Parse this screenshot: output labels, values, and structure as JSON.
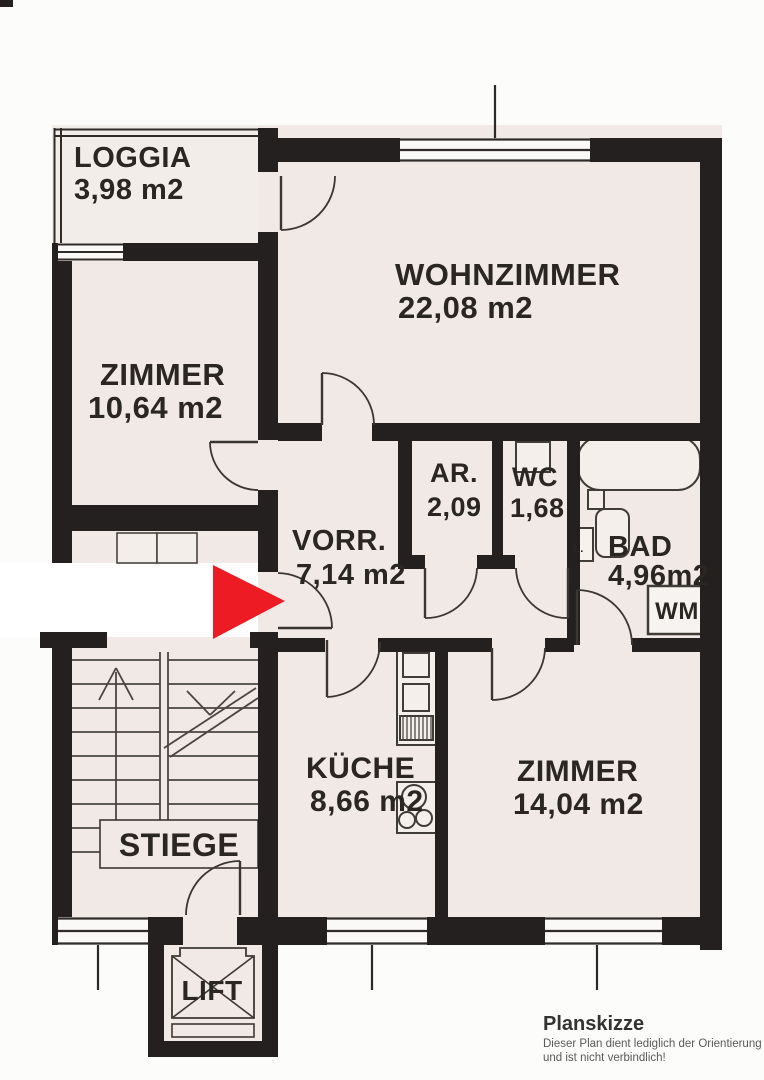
{
  "plan": {
    "rooms": [
      {
        "name": "LOGGIA",
        "area": "3,98 m2"
      },
      {
        "name": "WOHNZIMMER",
        "area": "22,08 m2"
      },
      {
        "name": "ZIMMER",
        "area": "10,64 m2"
      },
      {
        "name": "VORR.",
        "area": "7,14 m2"
      },
      {
        "name": "AR.",
        "area": "2,09"
      },
      {
        "name": "WC",
        "area": "1,68"
      },
      {
        "name": "BAD",
        "area": "4,96m2"
      },
      {
        "name": "KÜCHE",
        "area": "8,66 m2"
      },
      {
        "name": "ZIMMER",
        "area": "14,04 m2"
      }
    ],
    "labels": {
      "stairs": "STIEGE",
      "lift": "LIFT",
      "washing_machine": "WM",
      "closet": "L."
    }
  },
  "footer": {
    "title": "Planskizze",
    "note_line1": "Dieser Plan dient lediglich der Orientierung",
    "note_line2": "und ist nicht verbindlich!"
  },
  "colors": {
    "wall": "#242020",
    "paper": "#f0e9e5",
    "arrow": "#ed1c24",
    "line": "#3c3834"
  }
}
